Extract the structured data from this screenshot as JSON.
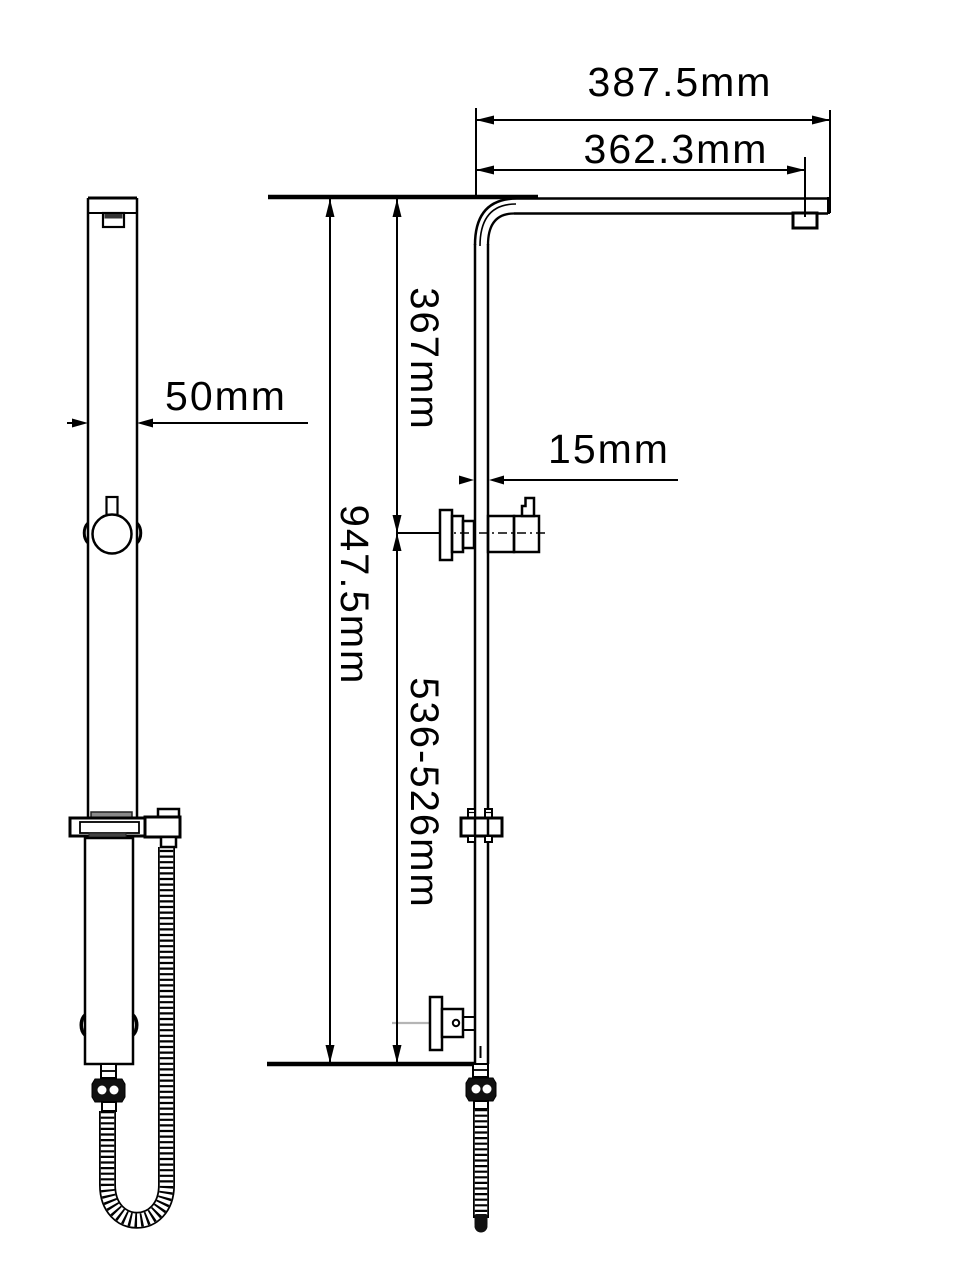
{
  "drawing": {
    "kind": "shower-rail-dimension-drawing",
    "dimensions": {
      "arm_overall_width": "387.5mm",
      "arm_to_outlet_width": "362.3mm",
      "top_to_diverter_height": "367mm",
      "pipe_depth": "15mm",
      "rail_width": "50mm",
      "overall_height": "947.5mm",
      "diverter_to_inlet_height_range": "536-526mm"
    },
    "colors": {
      "line": "#000000",
      "background": "#ffffff",
      "pad_gray": "#8a8a8a",
      "pad_dark_gray": "#444444",
      "centerline_gray": "#b5b5b5"
    }
  }
}
